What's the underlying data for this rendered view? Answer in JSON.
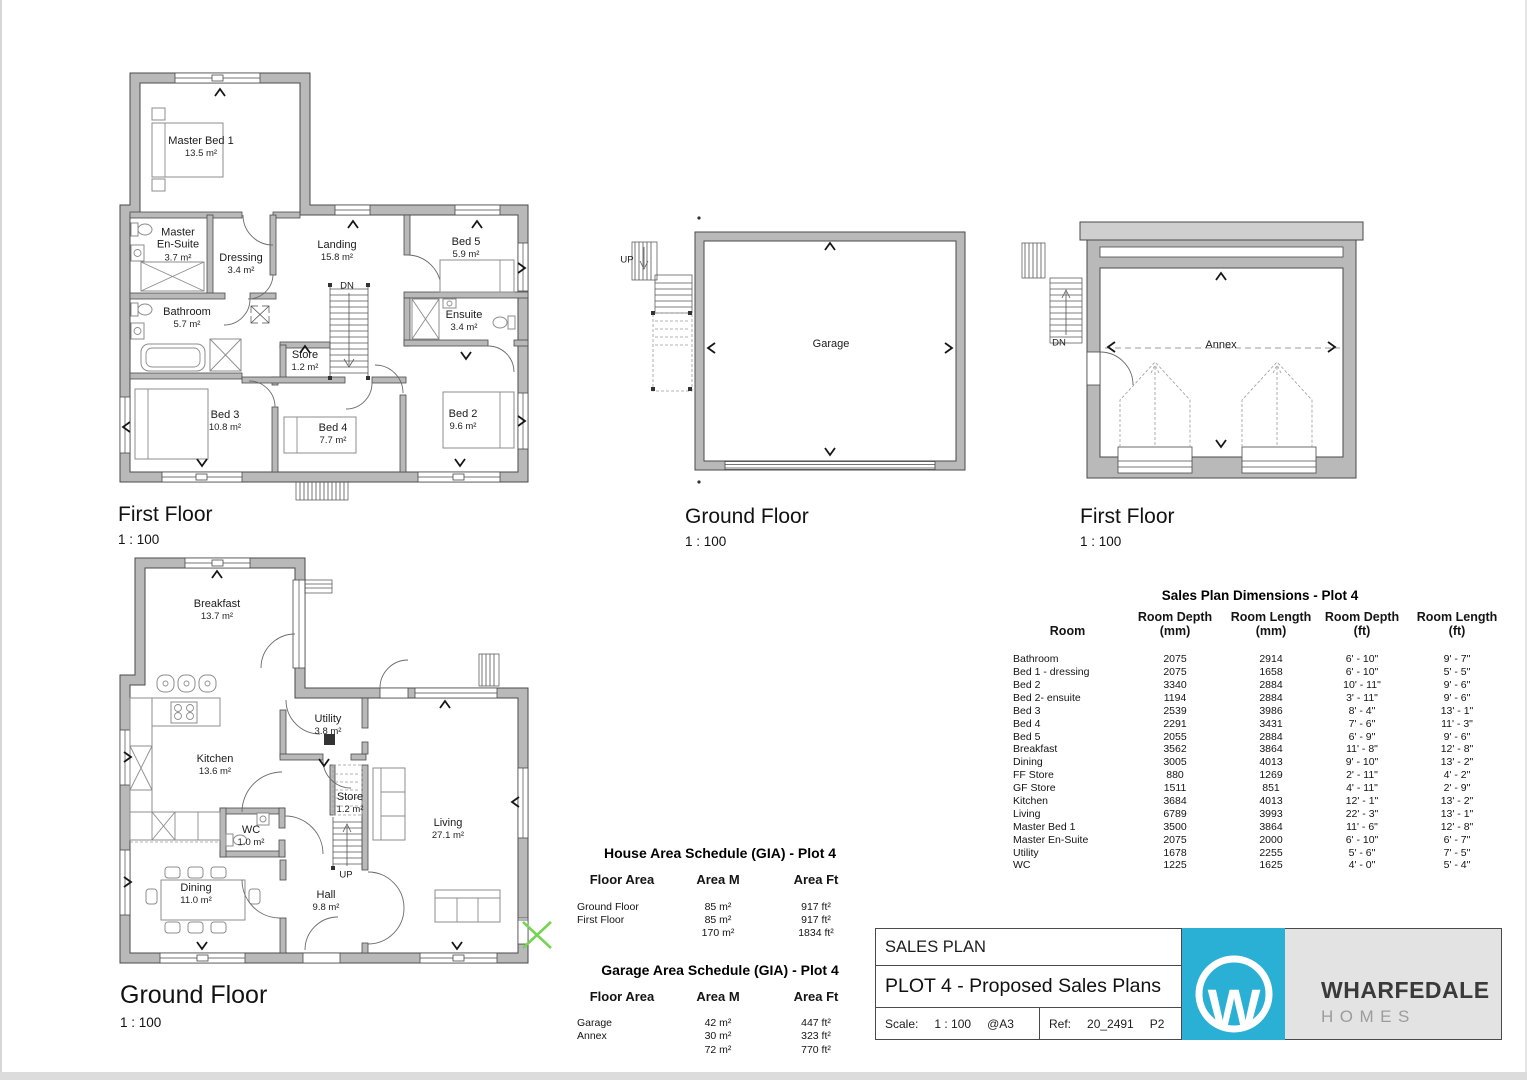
{
  "plans": {
    "house_first_floor": {
      "title": "First Floor",
      "scale": "1 : 100",
      "stair": "DN",
      "rooms": {
        "master_bed": {
          "name": "Master Bed 1",
          "area": "13.5 m²"
        },
        "master_ensuite": {
          "name": "Master\nEn-Suite",
          "area": "3.7 m²"
        },
        "dressing": {
          "name": "Dressing",
          "area": "3.4 m²"
        },
        "landing": {
          "name": "Landing",
          "area": "15.8 m²"
        },
        "bed5": {
          "name": "Bed 5",
          "area": "5.9 m²"
        },
        "bathroom": {
          "name": "Bathroom",
          "area": "5.7 m²"
        },
        "ensuite": {
          "name": "Ensuite",
          "area": "3.4 m²"
        },
        "store": {
          "name": "Store",
          "area": "1.2 m²"
        },
        "bed3": {
          "name": "Bed 3",
          "area": "10.8 m²"
        },
        "bed4": {
          "name": "Bed 4",
          "area": "7.7 m²"
        },
        "bed2": {
          "name": "Bed 2",
          "area": "9.6 m²"
        }
      }
    },
    "garage_ground_floor": {
      "title": "Ground Floor",
      "scale": "1 : 100",
      "stair": "UP",
      "rooms": {
        "garage": {
          "name": "Garage",
          "area": ""
        }
      }
    },
    "annex_first_floor": {
      "title": "First Floor",
      "scale": "1 : 100",
      "stair": "DN",
      "rooms": {
        "annex": {
          "name": "Annex",
          "area": ""
        }
      }
    },
    "house_ground_floor": {
      "title": "Ground Floor",
      "scale": "1 : 100",
      "stair": "UP",
      "rooms": {
        "breakfast": {
          "name": "Breakfast",
          "area": "13.7 m²"
        },
        "kitchen": {
          "name": "Kitchen",
          "area": "13.6 m²"
        },
        "utility": {
          "name": "Utility",
          "area": "3.8 m²"
        },
        "store": {
          "name": "Store",
          "area": "1.2 m²"
        },
        "wc": {
          "name": "WC",
          "area": "1.0 m²"
        },
        "dining": {
          "name": "Dining",
          "area": "11.0 m²"
        },
        "hall": {
          "name": "Hall",
          "area": "9.8 m²"
        },
        "living": {
          "name": "Living",
          "area": "27.1 m²"
        }
      }
    }
  },
  "dimensions_table": {
    "title": "Sales Plan Dimensions  - Plot 4",
    "headers": [
      "Room",
      "Room Depth\n(mm)",
      "Room Length\n(mm)",
      "Room Depth\n(ft)",
      "Room Length\n(ft)"
    ],
    "rows": [
      {
        "room": "Bathroom",
        "depth_mm": "2075",
        "length_mm": "2914",
        "depth_ft": "6' - 10\"",
        "length_ft": "9' - 7\""
      },
      {
        "room": "Bed 1 - dressing",
        "depth_mm": "2075",
        "length_mm": "1658",
        "depth_ft": "6' - 10\"",
        "length_ft": "5' - 5\""
      },
      {
        "room": "Bed 2",
        "depth_mm": "3340",
        "length_mm": "2884",
        "depth_ft": "10' - 11\"",
        "length_ft": "9' - 6\""
      },
      {
        "room": "Bed 2- ensuite",
        "depth_mm": "1194",
        "length_mm": "2884",
        "depth_ft": "3' - 11\"",
        "length_ft": "9' - 6\""
      },
      {
        "room": "Bed 3",
        "depth_mm": "2539",
        "length_mm": "3986",
        "depth_ft": "8' - 4\"",
        "length_ft": "13' - 1\""
      },
      {
        "room": "Bed 4",
        "depth_mm": "2291",
        "length_mm": "3431",
        "depth_ft": "7' - 6\"",
        "length_ft": "11' - 3\""
      },
      {
        "room": "Bed 5",
        "depth_mm": "2055",
        "length_mm": "2884",
        "depth_ft": "6' - 9\"",
        "length_ft": "9' - 6\""
      },
      {
        "room": "Breakfast",
        "depth_mm": "3562",
        "length_mm": "3864",
        "depth_ft": "11' - 8\"",
        "length_ft": "12' - 8\""
      },
      {
        "room": "Dining",
        "depth_mm": "3005",
        "length_mm": "4013",
        "depth_ft": "9' - 10\"",
        "length_ft": "13' - 2\""
      },
      {
        "room": "FF Store",
        "depth_mm": "880",
        "length_mm": "1269",
        "depth_ft": "2' - 11\"",
        "length_ft": "4' - 2\""
      },
      {
        "room": "GF Store",
        "depth_mm": "1511",
        "length_mm": "851",
        "depth_ft": "4' - 11\"",
        "length_ft": "2' - 9\""
      },
      {
        "room": "Kitchen",
        "depth_mm": "3684",
        "length_mm": "4013",
        "depth_ft": "12' - 1\"",
        "length_ft": "13' - 2\""
      },
      {
        "room": "Living",
        "depth_mm": "6789",
        "length_mm": "3993",
        "depth_ft": "22' - 3\"",
        "length_ft": "13' - 1\""
      },
      {
        "room": "Master Bed 1",
        "depth_mm": "3500",
        "length_mm": "3864",
        "depth_ft": "11' - 6\"",
        "length_ft": "12' - 8\""
      },
      {
        "room": "Master En-Suite",
        "depth_mm": "2075",
        "length_mm": "2000",
        "depth_ft": "6' - 10\"",
        "length_ft": "6' - 7\""
      },
      {
        "room": "Utility",
        "depth_mm": "1678",
        "length_mm": "2255",
        "depth_ft": "5' - 6\"",
        "length_ft": "7' - 5\""
      },
      {
        "room": "WC",
        "depth_mm": "1225",
        "length_mm": "1625",
        "depth_ft": "4' - 0\"",
        "length_ft": "5' - 4\""
      }
    ]
  },
  "house_area_schedule": {
    "title": "House Area Schedule (GIA) - Plot 4",
    "headers": [
      "Floor Area",
      "Area M",
      "Area Ft"
    ],
    "rows": [
      {
        "floor": "Ground Floor",
        "m": "85 m²",
        "ft": "917 ft²"
      },
      {
        "floor": "First Floor",
        "m": "85 m²",
        "ft": "917 ft²"
      },
      {
        "floor": "",
        "m": "170 m²",
        "ft": "1834 ft²"
      }
    ]
  },
  "garage_area_schedule": {
    "title": "Garage Area Schedule (GIA) - Plot 4",
    "headers": [
      "Floor Area",
      "Area M",
      "Area Ft"
    ],
    "rows": [
      {
        "floor": "Garage",
        "m": "42 m²",
        "ft": "447 ft²"
      },
      {
        "floor": "Annex",
        "m": "30 m²",
        "ft": "323 ft²"
      },
      {
        "floor": "",
        "m": "72 m²",
        "ft": "770 ft²"
      }
    ]
  },
  "title_block": {
    "doc_type": "SALES PLAN",
    "drawing_title": "PLOT 4 - Proposed Sales Plans",
    "scale_label": "Scale:",
    "scale_value": "1 : 100",
    "paper": "@A3",
    "ref_label": "Ref:",
    "ref_value": "20_2491",
    "revision": "P2"
  },
  "logo": {
    "letter": "W",
    "brand": "WHARFEDALE",
    "sub": "HOMES",
    "accent_color": "#29b0d4"
  },
  "colors": {
    "wall_fill": "#b9b9b9",
    "wall_edge": "#4a4a4a",
    "marker_green": "#76d455"
  }
}
